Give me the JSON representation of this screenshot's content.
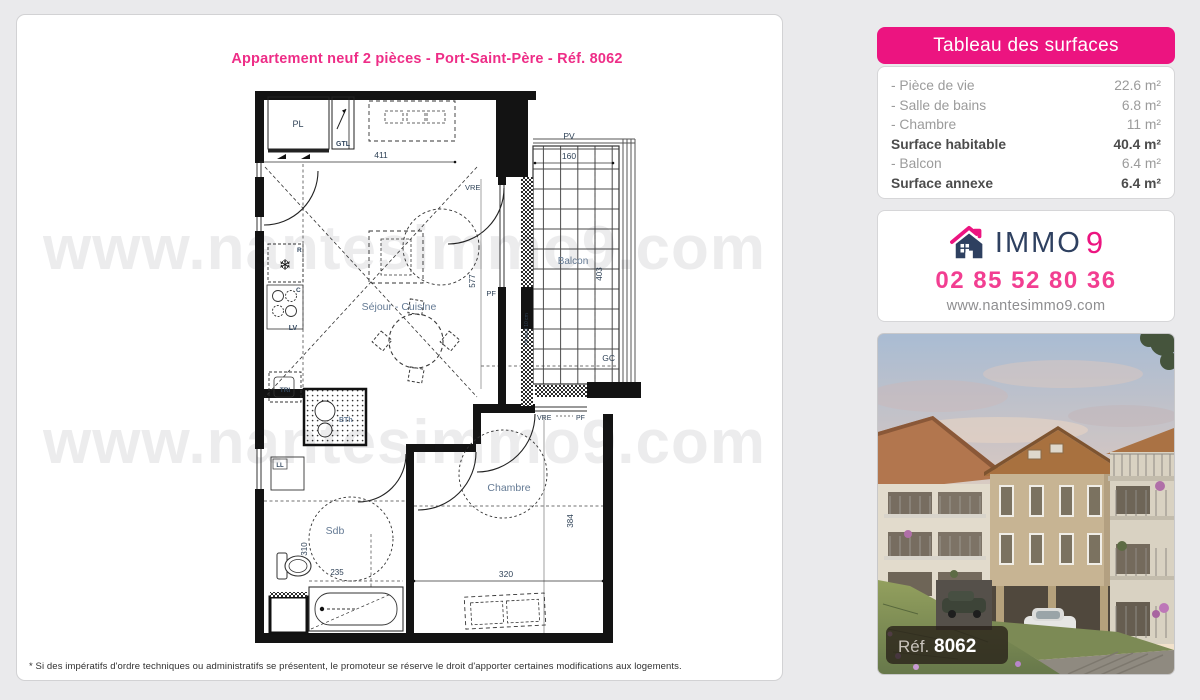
{
  "listing": {
    "title": "Appartement neuf 2 pièces - Port-Saint-Père - Réf. 8062"
  },
  "watermark": "www.nantesimmo9.com",
  "footer": {
    "disclaimer": "* Si des impératifs d'ordre techniques ou administratifs se présentent, le promoteur se réserve le droit d'apporter certaines modifications aux logements."
  },
  "surfaces": {
    "header": "Tableau des surfaces",
    "rows": [
      {
        "label": "- Pièce de vie",
        "value": "22.6 m²",
        "bold": false
      },
      {
        "label": "- Salle de bains",
        "value": "6.8 m²",
        "bold": false
      },
      {
        "label": "- Chambre",
        "value": "11 m²",
        "bold": false
      },
      {
        "label": "Surface habitable",
        "value": "40.4 m²",
        "bold": true
      },
      {
        "label": "- Balcon",
        "value": "6.4 m²",
        "bold": false
      },
      {
        "label": "Surface annexe",
        "value": "6.4 m²",
        "bold": true
      }
    ]
  },
  "agency": {
    "brand_immo": "IMMO",
    "brand_9": "9",
    "phone": "02 85 52 80 36",
    "website": "www.nantesimmo9.com"
  },
  "photo": {
    "ref_label": "Réf.",
    "ref_number": "8062"
  },
  "plan": {
    "rooms": {
      "sejour": "Séjour - Cuisine",
      "chambre": "Chambre",
      "sdb": "Sdb",
      "balcon": "Balcon"
    },
    "equipment": {
      "pl": "PL",
      "gtl": "GTL",
      "r": "R",
      "c": "C",
      "lv": "LV",
      "tri": "TRI",
      "bth": "BTh",
      "ll": "LL",
      "pv": "PV",
      "gc": "GC",
      "vre_sejour": "VRE",
      "pf_sejour": "PF",
      "vre_chambre": "VRE",
      "pf_chambre": "PF",
      "ht_seuil": "Ht seuil 10 cm"
    },
    "dims": {
      "top": "411",
      "balcon_w": "160",
      "sejour_h": "577",
      "balcon_h": "403",
      "chambre_h": "384",
      "chambre_w": "320",
      "sdb_h": "310",
      "sdb_w": "235"
    }
  },
  "colors": {
    "pink": "#ec1480",
    "navy": "#2e4060",
    "page_bg": "#eaeaec"
  }
}
